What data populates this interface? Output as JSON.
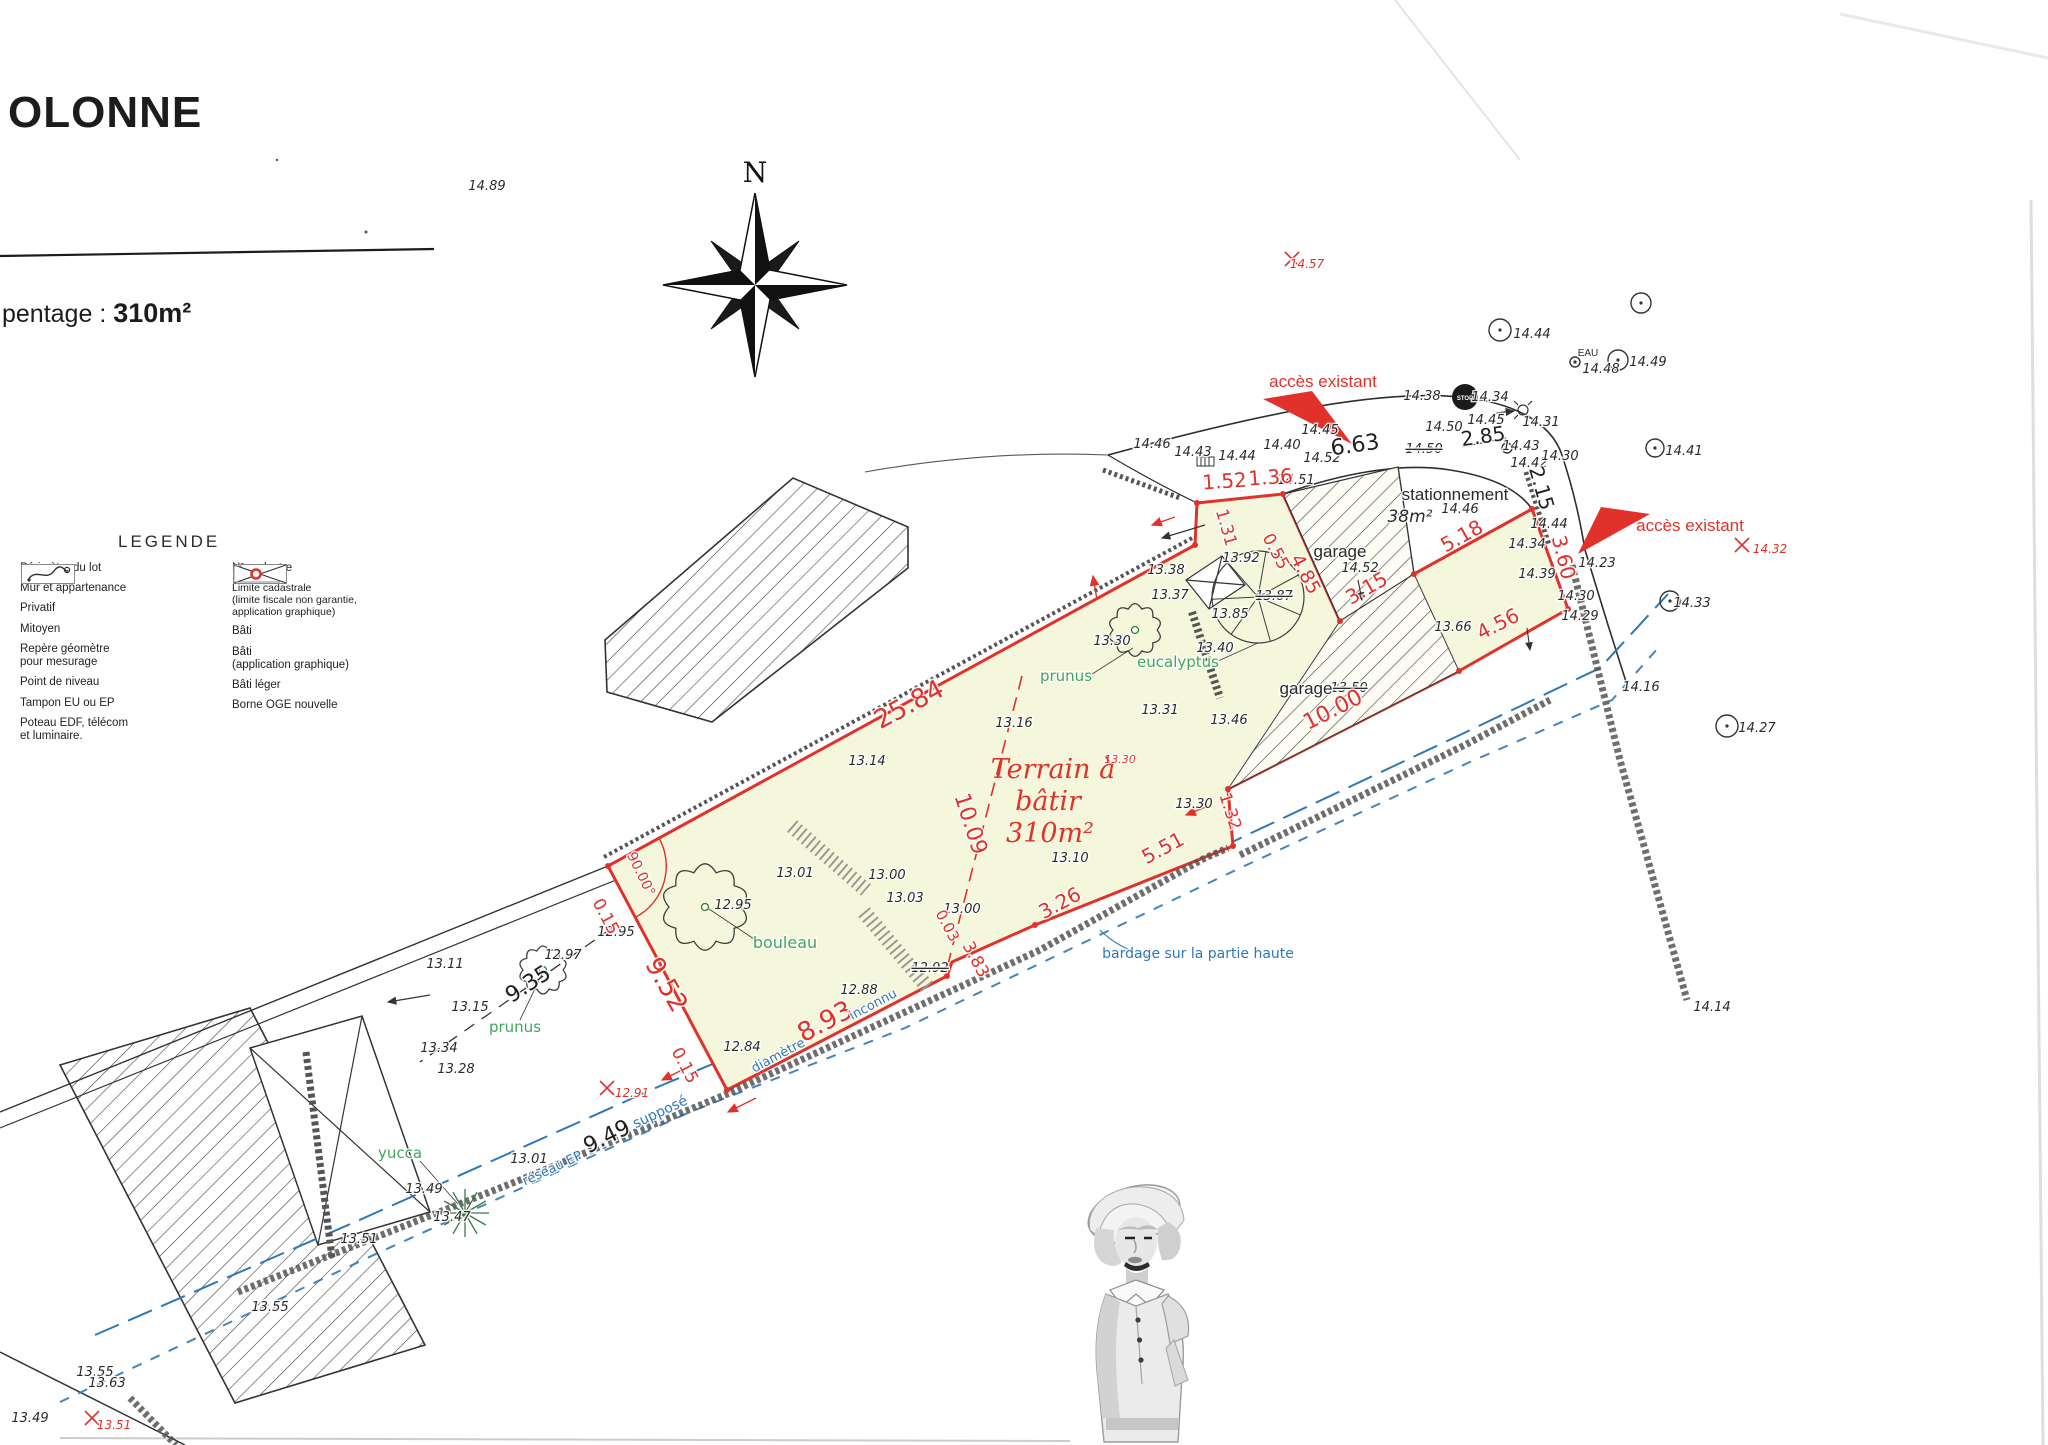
{
  "colors": {
    "red": "#e0322b",
    "blue": "#2f78b8",
    "green": "#3fa65c",
    "ink": "#262626",
    "parcel_fill": "#f5f7dd",
    "paper": "#ffffff"
  },
  "header": {
    "title": "OLONNE",
    "area_prefix": "pentage :",
    "area_value": "310m²"
  },
  "compass_label": "N",
  "legend": {
    "title": "LEGENDE",
    "left": [
      {
        "label": "Périmètre du lot",
        "icon": "perimetre"
      },
      {
        "label": "Mur et appartenance",
        "icon": "mur"
      },
      {
        "label": "Privatif",
        "icon": "privatif"
      },
      {
        "label": "Mitoyen",
        "icon": "mitoyen"
      },
      {
        "label": "Repère géomètre\npour mesurage",
        "icon": "repere",
        "value": "10.47"
      },
      {
        "label": "Point de niveau",
        "icon": "niveau",
        "value": "10.47"
      },
      {
        "label": "Tampon EU ou EP",
        "icon": "tampon",
        "value": "10.47"
      },
      {
        "label": "Poteau EDF, télécom\net luminaire.",
        "icon": "poteau"
      }
    ],
    "right": [
      {
        "label": "N° cadastre",
        "icon": "cadastre",
        "value": "AH n°742"
      },
      {
        "label": "Limite cadastrale\n(limite fiscale non garantie,\napplication graphique)",
        "icon": "limite"
      },
      {
        "label": "Bâti",
        "icon": "bati"
      },
      {
        "label": "Bâti\n(application graphique)",
        "icon": "bati-app"
      },
      {
        "label": "Bâti léger",
        "icon": "bati-leger"
      },
      {
        "label": "Borne OGE nouvelle",
        "icon": "borne"
      }
    ]
  },
  "plan": {
    "labels": [
      {
        "t": "14.89",
        "x": 487,
        "y": 190
      },
      {
        "t": "14.44",
        "x": 1532,
        "y": 338
      },
      {
        "t": "EAU",
        "x": 1588,
        "y": 356,
        "s": 10,
        "c": "kt"
      },
      {
        "t": "14.48",
        "x": 1601,
        "y": 373
      },
      {
        "t": "14.49",
        "x": 1648,
        "y": 366
      },
      {
        "t": "14.41",
        "x": 1684,
        "y": 455
      },
      {
        "t": "14.46",
        "x": 1152,
        "y": 448
      },
      {
        "t": "14.43",
        "x": 1193,
        "y": 456
      },
      {
        "t": "14.44",
        "x": 1237,
        "y": 460
      },
      {
        "t": "14.40",
        "x": 1282,
        "y": 449
      },
      {
        "t": "14.45",
        "x": 1320,
        "y": 434
      },
      {
        "t": "14.38",
        "x": 1422,
        "y": 400
      },
      {
        "t": "14.34",
        "x": 1490,
        "y": 401
      },
      {
        "t": "14.50",
        "x": 1444,
        "y": 431
      },
      {
        "t": "14.45",
        "x": 1486,
        "y": 424
      },
      {
        "t": "14.50",
        "x": 1424,
        "y": 453,
        "st": 1
      },
      {
        "t": "14.43",
        "x": 1521,
        "y": 450
      },
      {
        "t": "14.31",
        "x": 1541,
        "y": 426
      },
      {
        "t": "14.42",
        "x": 1529,
        "y": 467
      },
      {
        "t": "14.30",
        "x": 1560,
        "y": 460
      },
      {
        "t": "14.44",
        "x": 1549,
        "y": 528
      },
      {
        "t": "14.51",
        "x": 1296,
        "y": 484
      },
      {
        "t": "14.46",
        "x": 1460,
        "y": 513
      },
      {
        "t": "14.52",
        "x": 1322,
        "y": 462
      },
      {
        "t": "14.52",
        "x": 1360,
        "y": 572
      },
      {
        "t": "13.50",
        "x": 1349,
        "y": 692,
        "st": 1
      },
      {
        "t": "13.66",
        "x": 1453,
        "y": 631
      },
      {
        "t": "13.46",
        "x": 1229,
        "y": 724
      },
      {
        "t": "13.92",
        "x": 1241,
        "y": 562
      },
      {
        "t": "13.87",
        "x": 1274,
        "y": 600,
        "st": 1
      },
      {
        "t": "13.85",
        "x": 1230,
        "y": 618
      },
      {
        "t": "13.40",
        "x": 1215,
        "y": 652
      },
      {
        "t": "13.38",
        "x": 1166,
        "y": 574
      },
      {
        "t": "13.37",
        "x": 1170,
        "y": 599
      },
      {
        "t": "13.31",
        "x": 1160,
        "y": 714
      },
      {
        "t": "13.30",
        "x": 1112,
        "y": 645
      },
      {
        "t": "13.16",
        "x": 1014,
        "y": 727
      },
      {
        "t": "13.14",
        "x": 867,
        "y": 765
      },
      {
        "t": "13.10",
        "x": 1070,
        "y": 862
      },
      {
        "t": "13.30",
        "x": 1194,
        "y": 808
      },
      {
        "t": "13.00",
        "x": 962,
        "y": 913
      },
      {
        "t": "13.01",
        "x": 795,
        "y": 877
      },
      {
        "t": "13.00",
        "x": 887,
        "y": 879
      },
      {
        "t": "13.03",
        "x": 905,
        "y": 902
      },
      {
        "t": "12.95",
        "x": 616,
        "y": 936
      },
      {
        "t": "12.95",
        "x": 733,
        "y": 909
      },
      {
        "t": "12.84",
        "x": 742,
        "y": 1051
      },
      {
        "t": "12.88",
        "x": 859,
        "y": 994
      },
      {
        "t": "12.92",
        "x": 930,
        "y": 972,
        "st": 1
      },
      {
        "t": "12.97",
        "x": 563,
        "y": 959
      },
      {
        "t": "13.11",
        "x": 445,
        "y": 968
      },
      {
        "t": "13.15",
        "x": 470,
        "y": 1011
      },
      {
        "t": "13.34",
        "x": 439,
        "y": 1052
      },
      {
        "t": "13.28",
        "x": 456,
        "y": 1073
      },
      {
        "t": "13.49",
        "x": 424,
        "y": 1193
      },
      {
        "t": "13.47",
        "x": 452,
        "y": 1221
      },
      {
        "t": "13.01",
        "x": 529,
        "y": 1163
      },
      {
        "t": "13.51",
        "x": 359,
        "y": 1243
      },
      {
        "t": "13.55",
        "x": 270,
        "y": 1311
      },
      {
        "t": "13.55",
        "x": 95,
        "y": 1376
      },
      {
        "t": "13.63",
        "x": 107,
        "y": 1387
      },
      {
        "t": "13.49",
        "x": 30,
        "y": 1422
      },
      {
        "t": "14.33",
        "x": 1692,
        "y": 607
      },
      {
        "t": "14.16",
        "x": 1641,
        "y": 691
      },
      {
        "t": "14.27",
        "x": 1757,
        "y": 732
      },
      {
        "t": "14.14",
        "x": 1712,
        "y": 1011
      },
      {
        "t": "14.30",
        "x": 1576,
        "y": 600
      },
      {
        "t": "14.29",
        "x": 1580,
        "y": 620
      },
      {
        "t": "14.39",
        "x": 1537,
        "y": 578
      },
      {
        "t": "14.34",
        "x": 1527,
        "y": 548
      },
      {
        "t": "14.23",
        "x": 1597,
        "y": 567
      },
      {
        "t": "stationnement",
        "x": 1455,
        "y": 500,
        "s": 17,
        "c": "kt"
      },
      {
        "t": "38m²",
        "x": 1410,
        "y": 522,
        "c": "kti"
      },
      {
        "t": "garage",
        "x": 1340,
        "y": 557,
        "s": 17,
        "c": "kt"
      },
      {
        "t": "garage",
        "x": 1306,
        "y": 694,
        "s": 17,
        "c": "kt"
      },
      {
        "t": "6.63",
        "x": 1356,
        "y": 452,
        "r": -8,
        "s": 22,
        "c": "kb"
      },
      {
        "t": "2.85",
        "x": 1484,
        "y": 443,
        "r": -8,
        "s": 20,
        "c": "kb"
      },
      {
        "t": "2.15",
        "x": 1535,
        "y": 490,
        "r": 74,
        "s": 20,
        "c": "kb"
      },
      {
        "t": "9.49",
        "x": 610,
        "y": 1143,
        "r": -26,
        "s": 22,
        "c": "kb"
      },
      {
        "t": "9.35",
        "x": 532,
        "y": 990,
        "r": -33,
        "s": 22,
        "c": "kb"
      },
      {
        "t": "25.84",
        "x": 913,
        "y": 712,
        "r": -28,
        "s": 26,
        "c": "rd"
      },
      {
        "t": "9.52",
        "x": 659,
        "y": 989,
        "r": 60,
        "s": 26,
        "c": "rd"
      },
      {
        "t": "8.93",
        "x": 829,
        "y": 1029,
        "r": -28,
        "s": 26,
        "c": "rd"
      },
      {
        "t": "10.09",
        "x": 964,
        "y": 826,
        "r": 72,
        "s": 22,
        "c": "rd"
      },
      {
        "t": "0.15",
        "x": 601,
        "y": 919,
        "r": 62,
        "s": 17,
        "c": "rd"
      },
      {
        "t": "0.15",
        "x": 680,
        "y": 1068,
        "r": 62,
        "s": 17,
        "c": "rd"
      },
      {
        "t": "90.00°",
        "x": 637,
        "y": 876,
        "r": 64,
        "s": 14,
        "c": "rd"
      },
      {
        "t": "1.52",
        "x": 1225,
        "y": 488,
        "r": -4,
        "s": 20,
        "c": "rd"
      },
      {
        "t": "1.36",
        "x": 1271,
        "y": 484,
        "r": -4,
        "s": 20,
        "c": "rd"
      },
      {
        "t": "1.31",
        "x": 1221,
        "y": 529,
        "r": 74,
        "s": 17,
        "c": "rd"
      },
      {
        "t": "0.55",
        "x": 1271,
        "y": 554,
        "r": 62,
        "s": 17,
        "c": "rd"
      },
      {
        "t": "4.85",
        "x": 1300,
        "y": 577,
        "r": 62,
        "s": 19,
        "c": "rd"
      },
      {
        "t": "3.15",
        "x": 1370,
        "y": 594,
        "r": -30,
        "s": 20,
        "c": "rd"
      },
      {
        "t": "5.18",
        "x": 1465,
        "y": 542,
        "r": -29,
        "s": 20,
        "c": "rd"
      },
      {
        "t": "3.60",
        "x": 1557,
        "y": 559,
        "r": 76,
        "s": 20,
        "c": "rd"
      },
      {
        "t": "4.56",
        "x": 1501,
        "y": 630,
        "r": -27,
        "s": 20,
        "c": "rd"
      },
      {
        "t": "10.00",
        "x": 1336,
        "y": 716,
        "r": -27,
        "s": 22,
        "c": "rd"
      },
      {
        "t": "5.51",
        "x": 1166,
        "y": 854,
        "r": -28,
        "s": 20,
        "c": "rd"
      },
      {
        "t": "3.26",
        "x": 1063,
        "y": 909,
        "r": -28,
        "s": 20,
        "c": "rd"
      },
      {
        "t": "1.32",
        "x": 1225,
        "y": 813,
        "r": 72,
        "s": 17,
        "c": "rd"
      },
      {
        "t": "0.03",
        "x": 943,
        "y": 928,
        "r": 62,
        "s": 15,
        "c": "rd"
      },
      {
        "t": "3.83",
        "x": 971,
        "y": 962,
        "r": 62,
        "s": 17,
        "c": "rd"
      },
      {
        "t": "accès existant",
        "x": 1323,
        "y": 387,
        "c": "ra"
      },
      {
        "t": "accès existant",
        "x": 1690,
        "y": 531,
        "c": "ra"
      },
      {
        "t": "14.57",
        "x": 1307,
        "y": 268,
        "c": "r"
      },
      {
        "t": "14.32",
        "x": 1770,
        "y": 553,
        "c": "r"
      },
      {
        "t": "12.91",
        "x": 632,
        "y": 1097,
        "c": "r"
      },
      {
        "t": "13.51",
        "x": 114,
        "y": 1429,
        "c": "r"
      },
      {
        "t": "13.30",
        "x": 1120,
        "y": 763,
        "s": 11,
        "c": "r"
      },
      {
        "t": "Terrain à",
        "x": 1053,
        "y": 778,
        "c": "rt"
      },
      {
        "t": "bâtir",
        "x": 1048,
        "y": 810,
        "c": "rt"
      },
      {
        "t": "310m²",
        "x": 1050,
        "y": 842,
        "c": "rt"
      },
      {
        "t": "bardage sur la partie haute",
        "x": 1198,
        "y": 958,
        "c": "bl"
      },
      {
        "t": "réseau EP",
        "x": 554,
        "y": 1172,
        "r": -25,
        "s": 13,
        "c": "bl"
      },
      {
        "t": "supposé",
        "x": 662,
        "y": 1116,
        "r": -25,
        "c": "bl"
      },
      {
        "t": "diamètre",
        "x": 780,
        "y": 1059,
        "r": -28,
        "s": 13,
        "c": "bl"
      },
      {
        "t": "inconnu",
        "x": 875,
        "y": 1008,
        "r": -28,
        "s": 13,
        "c": "bl"
      },
      {
        "t": "bouleau",
        "x": 785,
        "y": 948,
        "s": 16,
        "c": "g"
      },
      {
        "t": "prunus",
        "x": 1066,
        "y": 681,
        "c": "g"
      },
      {
        "t": "eucalyptus",
        "x": 1178,
        "y": 667,
        "c": "g"
      },
      {
        "t": "prunus",
        "x": 515,
        "y": 1032,
        "c": "g"
      },
      {
        "t": "yucca",
        "x": 400,
        "y": 1158,
        "c": "g"
      },
      {
        "t": "STOP",
        "x": 1465,
        "y": 400,
        "c": "ws"
      }
    ],
    "manholes": [
      {
        "x": 1500,
        "y": 330,
        "r": 11,
        "d": 1
      },
      {
        "x": 1641,
        "y": 303,
        "r": 10,
        "d": 1
      },
      {
        "x": 1618,
        "y": 360,
        "r": 10,
        "d": 1
      },
      {
        "x": 1655,
        "y": 448,
        "r": 9,
        "d": 1
      },
      {
        "x": 1670,
        "y": 601,
        "r": 10,
        "d": 1
      },
      {
        "x": 1727,
        "y": 726,
        "r": 11,
        "d": 1
      },
      {
        "x": 1507,
        "y": 448,
        "r": 5,
        "d": 0
      },
      {
        "x": 1575,
        "y": 362,
        "r": 5,
        "d": 1
      }
    ],
    "red_crosses": [
      {
        "x": 1292,
        "y": 259
      },
      {
        "x": 1742,
        "y": 545
      },
      {
        "x": 607,
        "y": 1088
      },
      {
        "x": 92,
        "y": 1418
      }
    ],
    "trees": [
      {
        "x": 705,
        "y": 907,
        "r": 36,
        "k": "cloud",
        "dot": 1,
        "n": "bouleau-icon"
      },
      {
        "x": 543,
        "y": 970,
        "r": 20,
        "k": "cloud",
        "dot": 1,
        "n": "prunus-icon"
      },
      {
        "x": 1135,
        "y": 630,
        "r": 22,
        "k": "cloud",
        "dot": 1,
        "n": "prunus-icon"
      },
      {
        "x": 1258,
        "y": 597,
        "r": 46,
        "k": "palm",
        "n": "eucalyptus-icon"
      },
      {
        "x": 465,
        "y": 1213,
        "r": 24,
        "k": "star",
        "n": "yucca-icon"
      }
    ]
  }
}
